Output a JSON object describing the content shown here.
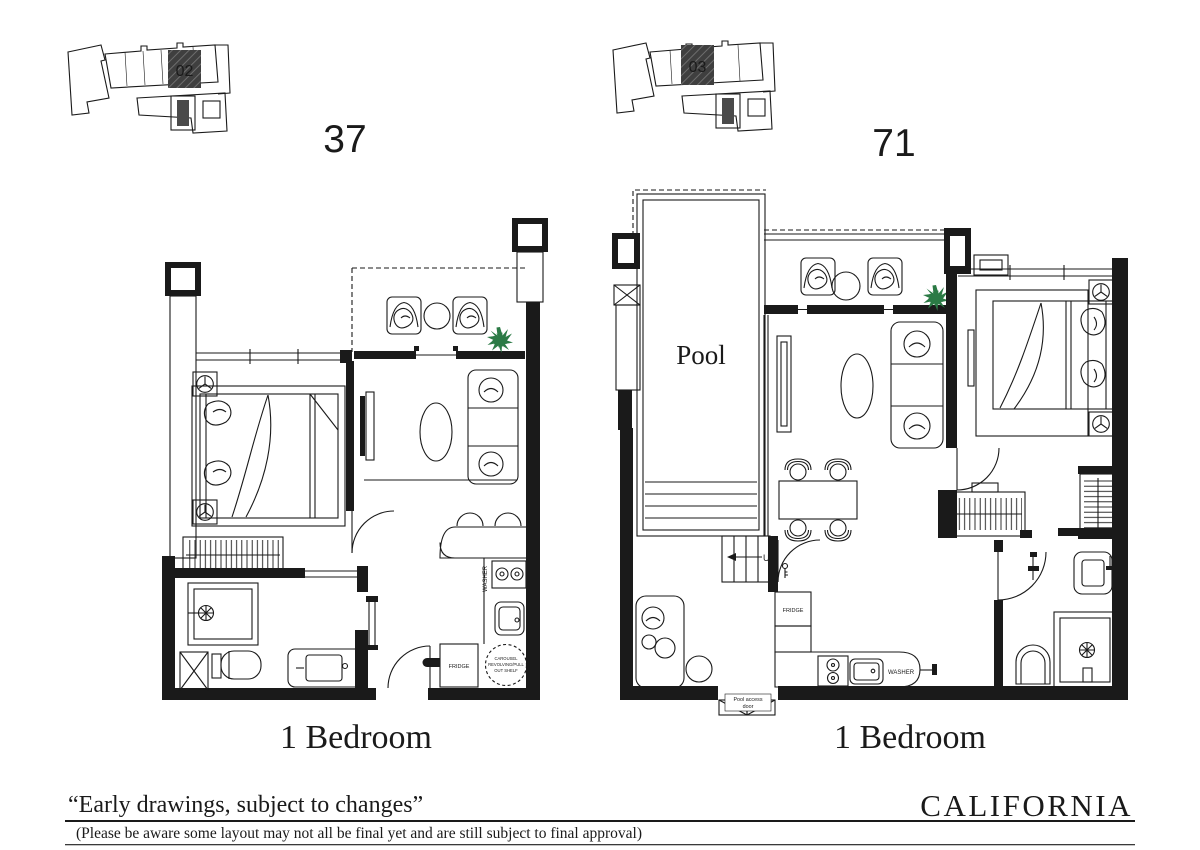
{
  "colors": {
    "ink": "#1a1a1a",
    "plant_green": "#2b7a45",
    "highlight_unit_fill": "#3f3f3f",
    "background": "#ffffff"
  },
  "key_plans": [
    {
      "unit_label": "02",
      "plan_number": "37"
    },
    {
      "unit_label": "03",
      "plan_number": "71"
    }
  ],
  "plan_left": {
    "title": "1 Bedroom",
    "washer": "WASHER",
    "fridge": "FRIDGE",
    "note1": "CAROUSEL",
    "note2": "REVOLVING/PULL",
    "note3": "OUT SHELF"
  },
  "plan_right": {
    "title": "1 Bedroom",
    "pool": "Pool",
    "up": "UP",
    "fridge": "FRIDGE",
    "washer": "WASHER",
    "door1": "Pool access",
    "door2": "door"
  },
  "footer": {
    "quote": "“Early drawings, subject to changes”",
    "disclaimer": "(Please be aware some layout may not all be final yet and are still subject to final approval)",
    "brand": "CALIFORNIA"
  }
}
